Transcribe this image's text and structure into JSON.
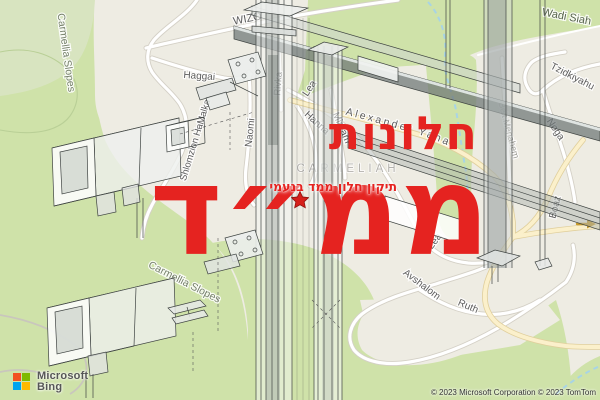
{
  "overlay": {
    "title_line1": "חלונות",
    "title_line2": "ממ״ד",
    "subtitle": "תיקון חלון ממד בנעמי",
    "accent_color": "#e52320",
    "star_color": "#d61f1a"
  },
  "map": {
    "neighborhood_label": "CARMELIAH",
    "park_labels": [
      "Carmellia Slopes",
      "Carmellia Slopes"
    ],
    "streets": {
      "wizo": "WIZO",
      "haggai": "Haggai",
      "shlomzion": "Shlomzion HaMalka",
      "naomi": "Naomi",
      "rivka": "Rivka",
      "lea": "Lea",
      "lea2": "Lea",
      "hanna": "Hanna",
      "miryam": "Miryam",
      "alexander_yanai": "Alexander Yanai",
      "boaz": "Boaz",
      "tzidkiyahu": "Tzidkiyahu",
      "noga": "Noga",
      "beit_menahem": "Beit Menahem",
      "wadi_siah": "Wadi Siah",
      "avshalom": "Avshalom",
      "ruth": "Ruth"
    },
    "colors": {
      "urban": "#eeece3",
      "park": "#cfe2a9",
      "park_light": "#d8e4c0",
      "road_fill": "#ffffff",
      "road_casing": "#d4d0c6",
      "main_road_fill": "#fbf0cb",
      "main_road_casing": "#e0cf9c",
      "water": "#a8d4e5"
    }
  },
  "branding": {
    "logo_line1": "Microsoft",
    "logo_line2": "Bing",
    "logo_colors": [
      "#f25022",
      "#7fba00",
      "#00a4ef",
      "#ffb900"
    ],
    "attribution": "© 2023 Microsoft Corporation © 2023 TomTom"
  }
}
